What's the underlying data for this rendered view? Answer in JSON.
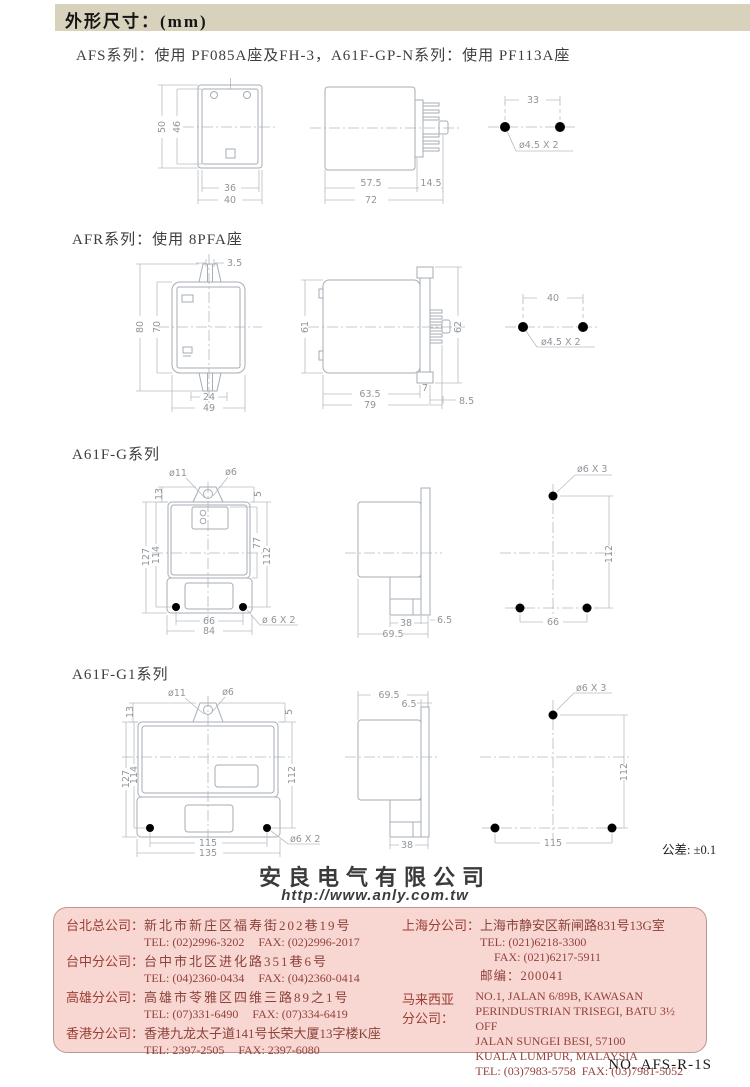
{
  "page": {
    "title": "外形尺寸：(mm)",
    "subtitle": "AFS系列：使用 PF085A座及FH-3，A61F-GP-N系列：使用 PF113A座",
    "tolerance_note": "公差: ±0.1",
    "doc_no": "NO. AFS-R-1S"
  },
  "section_titles": {
    "afr": "AFR系列：使用 8PFA座",
    "a61fg": "A61F-G系列",
    "a61fg1": "A61F-G1系列"
  },
  "afs": {
    "front": {
      "height_outer": "50",
      "height_inner": "46",
      "width_inner": "36",
      "width_outer": "40"
    },
    "side": {
      "body_depth": "57.5",
      "pin_depth": "14.5",
      "total_depth": "72"
    },
    "holes": {
      "pitch": "33",
      "hole_label": "ø4.5 X 2"
    }
  },
  "afr": {
    "front": {
      "tab_slot": "3.5",
      "height_outer": "80",
      "height_inner": "70",
      "width_inner": "24",
      "width_outer": "49"
    },
    "side": {
      "height_left": "61",
      "height_right": "62",
      "body_depth": "63.5",
      "flange": "7",
      "total_depth": "79",
      "pin_depth": "8.5"
    },
    "holes": {
      "pitch": "40",
      "hole_label": "ø4.5 X 2"
    }
  },
  "a61fg": {
    "front": {
      "top_hole": "ø11",
      "top_hole2": "ø6",
      "tab_height": "13",
      "tab_offset": "5",
      "height_outer": "127",
      "height_inner": "114",
      "panel_height": "77",
      "hole_height": "112",
      "hole_pitch": "66",
      "width_outer": "84",
      "hole_label": "ø 6 X 2"
    },
    "side": {
      "lower_depth": "38",
      "flange": "6.5",
      "total_depth": "69.5"
    },
    "holes": {
      "hole_label": "ø6 X 3",
      "vertical_pitch": "112",
      "horizontal_pitch": "66"
    }
  },
  "a61fg1": {
    "front": {
      "top_hole": "ø11",
      "top_hole2": "ø6",
      "tab_height": "13",
      "tab_offset": "5",
      "height_outer": "127",
      "height_inner": "114",
      "hole_height": "112",
      "hole_pitch": "115",
      "width_outer": "135",
      "hole_label": "ø6 X 2"
    },
    "side": {
      "total_depth": "69.5",
      "flange": "6.5",
      "lower_depth": "38"
    },
    "holes": {
      "hole_label": "ø6 X 3",
      "vertical_pitch": "112",
      "horizontal_pitch": "115"
    }
  },
  "company": {
    "name": "安良电气有限公司",
    "website": "http://www.anly.com.tw"
  },
  "contacts": {
    "left": [
      {
        "label": "台北总公司：",
        "address": "新北市新庄区福寿街202巷19号",
        "tel": "TEL: (02)2996-3202",
        "fax": "FAX: (02)2996-2017"
      },
      {
        "label": "台中分公司：",
        "address": "台中市北区进化路351巷6号",
        "tel": "TEL: (04)2360-0434",
        "fax": "FAX: (04)2360-0414"
      },
      {
        "label": "高雄分公司：",
        "address": "高雄市苓雅区四维三路89之1号",
        "tel": "TEL: (07)331-6490",
        "fax": "FAX: (07)334-6419"
      },
      {
        "label": "香港分公司：",
        "address": "香港九龙太子道141号长荣大厦13字楼K座",
        "tel": "TEL: 2397-2505",
        "fax": "FAX: 2397-6080"
      }
    ],
    "shanghai": {
      "label": "上海分公司：",
      "address": "上海市静安区新闸路831号13G室",
      "tel": "TEL: (021)6218-3300",
      "fax": "FAX: (021)6217-5911",
      "postal": "邮编：200041"
    },
    "malaysia": {
      "label_line1": "马来西亚",
      "label_line2": "分公司：",
      "addr1": "NO.1, JALAN 6/89B, KAWASAN",
      "addr2": "PERINDUSTRIAN TRISEGI, BATU 3½ OFF",
      "addr3": "JALAN SUNGEI BESI, 57100",
      "addr4": "KUALA LUMPUR, MALAYSIA",
      "tel": "TEL: (03)7983-5758",
      "fax": "FAX: (03)7981-5052"
    }
  }
}
